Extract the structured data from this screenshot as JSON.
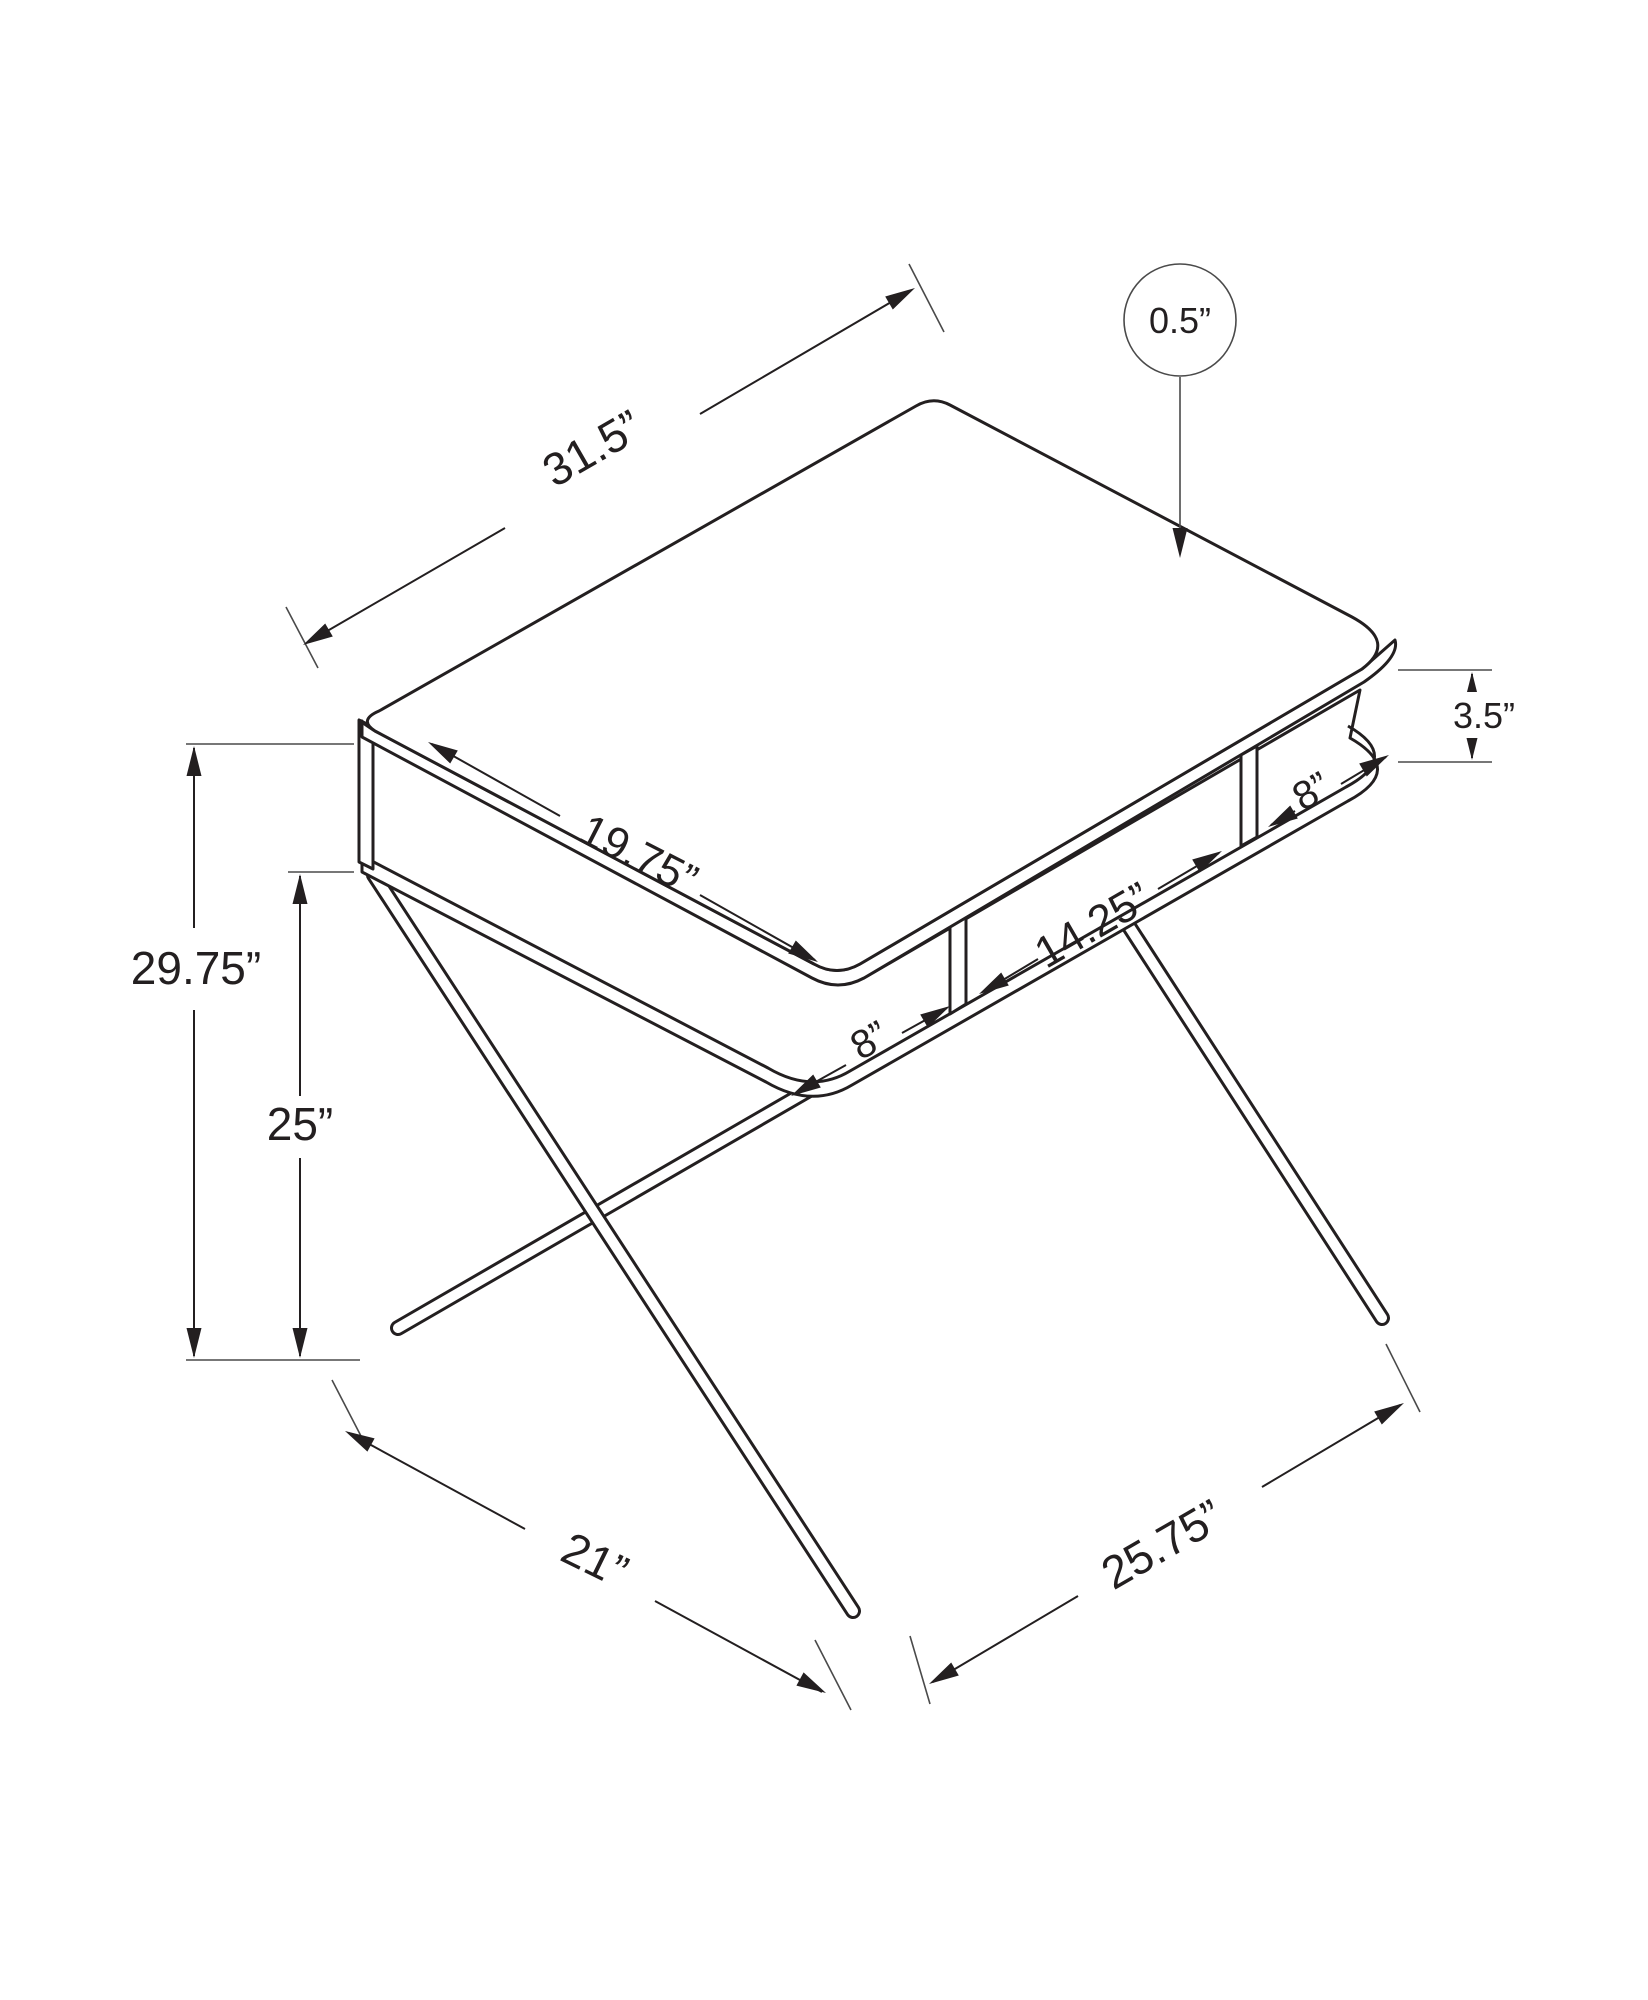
{
  "diagram": {
    "type": "isometric-dimension-drawing",
    "subject": "computer desk with open storage shelf cubbies and criss-cross metal legs",
    "unit": "inches",
    "colors": {
      "line": "#231f20",
      "background": "#ffffff"
    },
    "labels": {
      "desk_width": "31.5”",
      "top_thickness": "0.5”",
      "top_depth": "19.75”",
      "shelf_opening_height": "3.5”",
      "cubby_right_width": "8”",
      "cubby_center_width": "14.25”",
      "cubby_left_width": "8”",
      "overall_height": "29.75”",
      "shelf_surface_height": "25”",
      "base_depth": "21”",
      "base_width": "25.75”"
    }
  }
}
